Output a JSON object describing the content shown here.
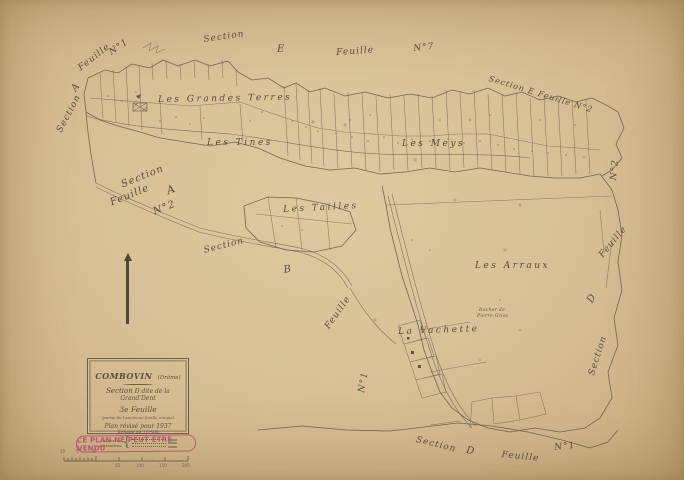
{
  "colors": {
    "paper": "#d8c197",
    "ink": "#5d5344",
    "stamp": "#b94f72"
  },
  "cartouche": {
    "commune": "COMBOVIN",
    "departement": "(Drôme)",
    "section_word": "Section",
    "section_name": "D dite de la Grand'Dent",
    "sheet": "3e Feuille",
    "sheet_note": "(partie de l'ancienne feuille unique)",
    "revision": "Plan révisé pour 1937",
    "scale_note": "Échelle de 1/2500",
    "legend_label_line1": "Numéros",
    "legend_label_line2": "périmètres",
    "legend_brace": "{"
  },
  "stamp": {
    "text": "CE PLAN NE PEUT ÊTRE VENDU"
  },
  "edge_labels": {
    "tl_section": "Section",
    "tl_a": "A",
    "tl_feuille": "Feuille",
    "tl_n": "N°1",
    "top_section": "Section",
    "top_e": "E",
    "top_feuille": "Feuille",
    "top_n": "N°7",
    "tr_diag": "Section E Feuille N°2",
    "ml_section": "Section",
    "ml_a": "A",
    "ml_feuille": "Feuille",
    "ml_n": "N°2",
    "bl_section": "Section",
    "bl_b": "B",
    "bl_feuille": "Feuille",
    "bl_n": "N°1",
    "bot_section": "Section",
    "bot_d": "D",
    "bot_feuille": "Feuille",
    "bot_n": "N°1",
    "r_section": "Section",
    "r_d": "D",
    "r_feuille": "Feuille",
    "r_n": "N°2"
  },
  "place_names": {
    "grandes_terres": "Les Grandes Terres",
    "tines": "Les Tines",
    "meys": "Les Meys",
    "tailles": "Les Tailles",
    "arraux": "Les Arraux",
    "vachette": "La Vachette",
    "rocher_line1": "Rocher de",
    "rocher_line2": "Pierre Grise"
  },
  "scalebar": {
    "left": [
      "10",
      "5",
      "0"
    ],
    "right": [
      "50",
      "100",
      "150",
      "200"
    ]
  }
}
